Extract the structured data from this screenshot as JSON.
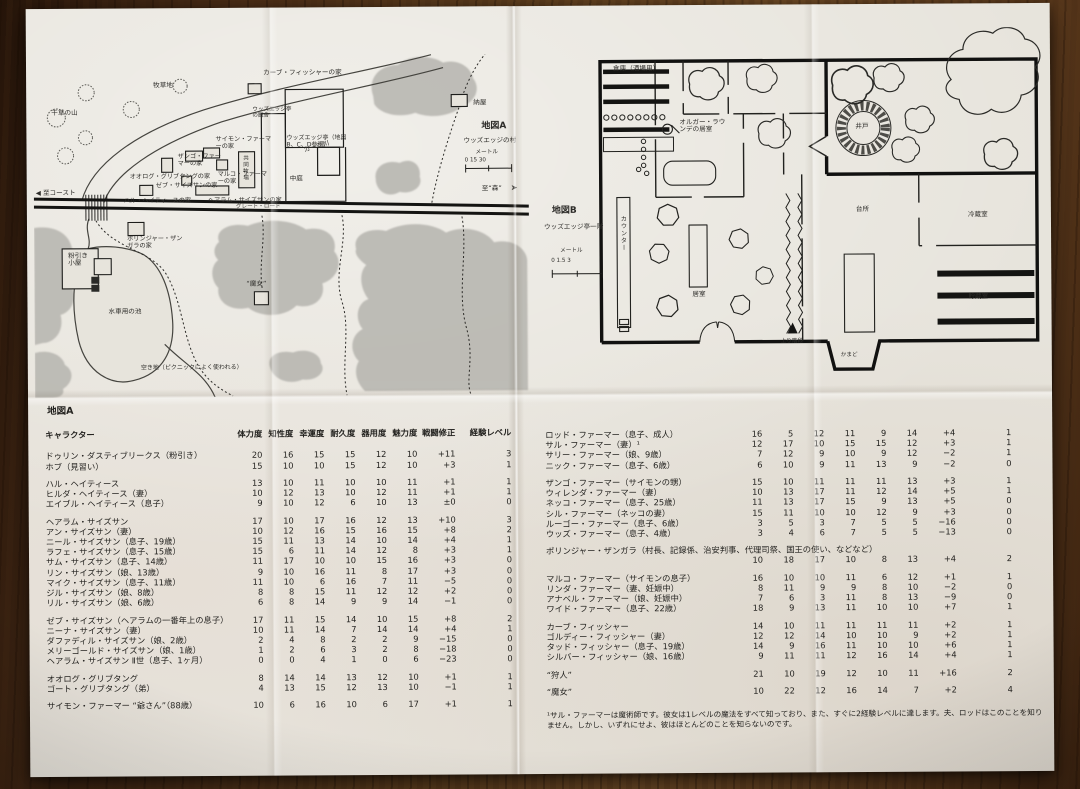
{
  "map_a": {
    "title": "地図A",
    "labels": {
      "pasture": "牧草地",
      "haystack": "干草の山",
      "river": "カージ川",
      "coast": "◀ 至コースト",
      "forest": "至“森”",
      "forest_arrow": "➤",
      "road_name": "グレート・ロード",
      "village": "ウッズエッジの村",
      "scale_unit": "メートル",
      "scale_ticks": "0        15        30",
      "barn": "納屋",
      "fisher_house": "カーブ・フィッシャーの家",
      "simon_house": "サイモン・ファーマーの家",
      "zango_house": "ザンゴ・ファーマーの家",
      "ohlog_house": "オオログ・グリブタングの家",
      "marco_house": "マルコ・ファーマーの家",
      "zeb_house": "ゼブ・サイズサンの家",
      "hal_house": "ハル・ヘイティースの家",
      "hairam_house": "ヘアラム・サイズサンの家",
      "common_pasture": "共同牧場",
      "inn_stable": "ウッズエッジ亭の厩舎",
      "inn": "ウッズエッジ亭（地図B、C、D参照）",
      "courtyard": "中庭",
      "polinjar_house": "ポリンジャー・ザンガラの家",
      "mill": "粉引き小屋",
      "mill_pond": "水車用の池",
      "witch": "“魔女”",
      "clearing": "空き地（ピクニックによく使われる）"
    }
  },
  "map_b": {
    "title": "地図B",
    "subtitle": "ウッズエッジ亭一階",
    "labels": {
      "storage": "倉庫（酒場用）",
      "olgar_room": "オルガー・ラウンデの居室",
      "well": "井戸",
      "counter": "カウンター",
      "common_room": "居室",
      "stairs": "上り階段",
      "kitchen": "台所",
      "cold_room": "冷蔵室",
      "pantry": "貯蔵室",
      "hearth": "かまど",
      "scale_unit": "メートル",
      "scale_ticks": "0    1.5    3"
    }
  },
  "stats": {
    "section_title": "地図A",
    "name_header": "キャラクター",
    "headers": [
      "体力度",
      "知性度",
      "幸運度",
      "耐久度",
      "器用度",
      "魅力度",
      "戦闘修正",
      "経験レベル"
    ],
    "left_groups": [
      [
        {
          "n": "ドゥリン・ダスティブリークス（粉引き）",
          "s": [
            "20",
            "16",
            "15",
            "15",
            "12",
            "10",
            "+11",
            "3"
          ]
        },
        {
          "n": "ホブ（見習い）",
          "s": [
            "15",
            "10",
            "10",
            "15",
            "12",
            "10",
            "+3",
            "1"
          ]
        }
      ],
      [
        {
          "n": "ハル・ヘイティース",
          "s": [
            "13",
            "10",
            "11",
            "10",
            "10",
            "11",
            "+1",
            "1"
          ]
        },
        {
          "n": "ヒルダ・ヘイティース（妻）",
          "s": [
            "10",
            "12",
            "13",
            "10",
            "12",
            "11",
            "+1",
            "1"
          ]
        },
        {
          "n": "エイブル・ヘイティース（息子）",
          "s": [
            "9",
            "10",
            "12",
            "6",
            "10",
            "13",
            "±0",
            "0"
          ]
        }
      ],
      [
        {
          "n": "ヘアラム・サイズサン",
          "s": [
            "17",
            "10",
            "17",
            "16",
            "12",
            "13",
            "+10",
            "3"
          ]
        },
        {
          "n": "アン・サイズサン（妻）",
          "s": [
            "10",
            "12",
            "16",
            "15",
            "16",
            "15",
            "+8",
            "2"
          ]
        },
        {
          "n": "ニール・サイズサン（息子、19歳）",
          "s": [
            "15",
            "11",
            "13",
            "14",
            "10",
            "14",
            "+4",
            "1"
          ]
        },
        {
          "n": "ラフェ・サイズサン（息子、15歳）",
          "s": [
            "15",
            "6",
            "11",
            "14",
            "12",
            "8",
            "+3",
            "1"
          ]
        },
        {
          "n": "サム・サイズサン（息子、14歳）",
          "s": [
            "11",
            "17",
            "10",
            "10",
            "15",
            "16",
            "+3",
            "0"
          ]
        },
        {
          "n": "リン・サイズサン（娘、13歳）",
          "s": [
            "9",
            "10",
            "16",
            "11",
            "8",
            "17",
            "+3",
            "0"
          ]
        },
        {
          "n": "マイク・サイズサン（息子、11歳）",
          "s": [
            "11",
            "10",
            "6",
            "16",
            "7",
            "11",
            "−5",
            "0"
          ]
        },
        {
          "n": "ジル・サイズサン（娘、8歳）",
          "s": [
            "8",
            "8",
            "15",
            "11",
            "12",
            "12",
            "+2",
            "0"
          ]
        },
        {
          "n": "リル・サイズサン（娘、6歳）",
          "s": [
            "6",
            "8",
            "14",
            "9",
            "9",
            "14",
            "−1",
            "0"
          ]
        }
      ],
      [
        {
          "n": "ゼブ・サイズサン（ヘアラムの一番年上の息子）",
          "s": [
            "17",
            "11",
            "15",
            "14",
            "10",
            "15",
            "+8",
            "2"
          ]
        },
        {
          "n": "ニーナ・サイズサン（妻）",
          "s": [
            "10",
            "11",
            "14",
            "7",
            "14",
            "14",
            "+4",
            "1"
          ]
        },
        {
          "n": "ダファディル・サイズサン（娘、2歳）",
          "s": [
            "2",
            "4",
            "8",
            "2",
            "2",
            "9",
            "−15",
            "0"
          ]
        },
        {
          "n": "メリーゴールド・サイズサン（娘、1歳）",
          "s": [
            "1",
            "2",
            "6",
            "3",
            "2",
            "8",
            "−18",
            "0"
          ]
        },
        {
          "n": "ヘアラム・サイズサン Ⅱ世（息子、1ヶ月）",
          "s": [
            "0",
            "0",
            "4",
            "1",
            "0",
            "6",
            "−23",
            "0"
          ]
        }
      ],
      [
        {
          "n": "オオログ・グリブタング",
          "s": [
            "8",
            "14",
            "14",
            "13",
            "12",
            "10",
            "+1",
            "1"
          ]
        },
        {
          "n": "ゴート・グリブタング（弟）",
          "s": [
            "4",
            "13",
            "15",
            "12",
            "13",
            "10",
            "−1",
            "1"
          ]
        }
      ],
      [
        {
          "n": "サイモン・ファーマー “爺さん”（88歳）",
          "s": [
            "10",
            "6",
            "16",
            "10",
            "6",
            "17",
            "+1",
            "1"
          ]
        }
      ]
    ],
    "right_groups": [
      [
        {
          "n": "ロッド・ファーマー（息子、成人）",
          "s": [
            "16",
            "5",
            "12",
            "11",
            "9",
            "14",
            "+4",
            "1"
          ]
        },
        {
          "n": "サル・ファーマー（妻）¹",
          "s": [
            "12",
            "17",
            "10",
            "15",
            "15",
            "12",
            "+3",
            "1"
          ]
        },
        {
          "n": "サリー・ファーマー（娘、9歳）",
          "s": [
            "7",
            "12",
            "9",
            "10",
            "9",
            "12",
            "−2",
            "1"
          ]
        },
        {
          "n": "ニック・ファーマー（息子、6歳）",
          "s": [
            "6",
            "10",
            "9",
            "11",
            "13",
            "9",
            "−2",
            "0"
          ]
        }
      ],
      [
        {
          "n": "ザンゴ・ファーマー（サイモンの甥）",
          "s": [
            "15",
            "10",
            "11",
            "11",
            "11",
            "13",
            "+3",
            "1"
          ]
        },
        {
          "n": "ウィレンダ・ファーマー（妻）",
          "s": [
            "10",
            "13",
            "17",
            "11",
            "12",
            "14",
            "+5",
            "1"
          ]
        },
        {
          "n": "ネッコ・ファーマー（息子、25歳）",
          "s": [
            "11",
            "13",
            "17",
            "15",
            "9",
            "13",
            "+5",
            "0"
          ]
        },
        {
          "n": "シル・ファーマー（ネッコの妻）",
          "s": [
            "15",
            "11",
            "10",
            "10",
            "12",
            "9",
            "+3",
            "0"
          ]
        },
        {
          "n": "ルーゴー・ファーマー（息子、6歳）",
          "s": [
            "3",
            "5",
            "3",
            "7",
            "5",
            "5",
            "−16",
            "0"
          ]
        },
        {
          "n": "ウッズ・ファーマー（息子、4歳）",
          "s": [
            "3",
            "4",
            "6",
            "7",
            "5",
            "5",
            "−13",
            "0"
          ]
        }
      ],
      [
        {
          "n": "ポリンジャー・ザンガラ（村長、記録係、治安判事、代理司祭、国王の使い、などなど）",
          "s": [
            "10",
            "18",
            "17",
            "10",
            "8",
            "13",
            "+4",
            "2"
          ],
          "full": true
        }
      ],
      [
        {
          "n": "マルコ・ファーマー（サイモンの息子）",
          "s": [
            "16",
            "10",
            "10",
            "11",
            "6",
            "12",
            "+1",
            "1"
          ]
        },
        {
          "n": "リンダ・ファーマー（妻、妊娠中）",
          "s": [
            "8",
            "11",
            "9",
            "9",
            "8",
            "10",
            "−2",
            "0"
          ]
        },
        {
          "n": "アナベル・ファーマー（娘、妊娠中）",
          "s": [
            "7",
            "6",
            "3",
            "11",
            "8",
            "13",
            "−9",
            "0"
          ]
        },
        {
          "n": "ワイド・ファーマー（息子、22歳）",
          "s": [
            "18",
            "9",
            "13",
            "11",
            "10",
            "10",
            "+7",
            "1"
          ]
        }
      ],
      [
        {
          "n": "カーブ・フィッシャー",
          "s": [
            "14",
            "10",
            "11",
            "11",
            "11",
            "11",
            "+2",
            "1"
          ]
        },
        {
          "n": "ゴルディー・フィッシャー（妻）",
          "s": [
            "12",
            "12",
            "14",
            "10",
            "10",
            "9",
            "+2",
            "1"
          ]
        },
        {
          "n": "タッド・フィッシャー（息子、19歳）",
          "s": [
            "14",
            "9",
            "16",
            "11",
            "10",
            "10",
            "+6",
            "1"
          ]
        },
        {
          "n": "シルバー・フィッシャー（娘、16歳）",
          "s": [
            "9",
            "11",
            "11",
            "12",
            "16",
            "14",
            "+4",
            "1"
          ]
        }
      ],
      [
        {
          "n": "“狩人”",
          "s": [
            "21",
            "10",
            "19",
            "12",
            "10",
            "11",
            "+16",
            "2"
          ]
        }
      ],
      [
        {
          "n": "“魔女”",
          "s": [
            "10",
            "22",
            "12",
            "16",
            "14",
            "7",
            "+2",
            "4"
          ]
        }
      ]
    ],
    "footnote": "¹サル・ファーマーは魔術師です。彼女は1レベルの魔法をすべて知っており、また、すぐに2経験レベルに達します。夫、ロッドはこのことを知りません。しかし、いずれにせよ、彼はほとんどのことを知らないのです。"
  }
}
